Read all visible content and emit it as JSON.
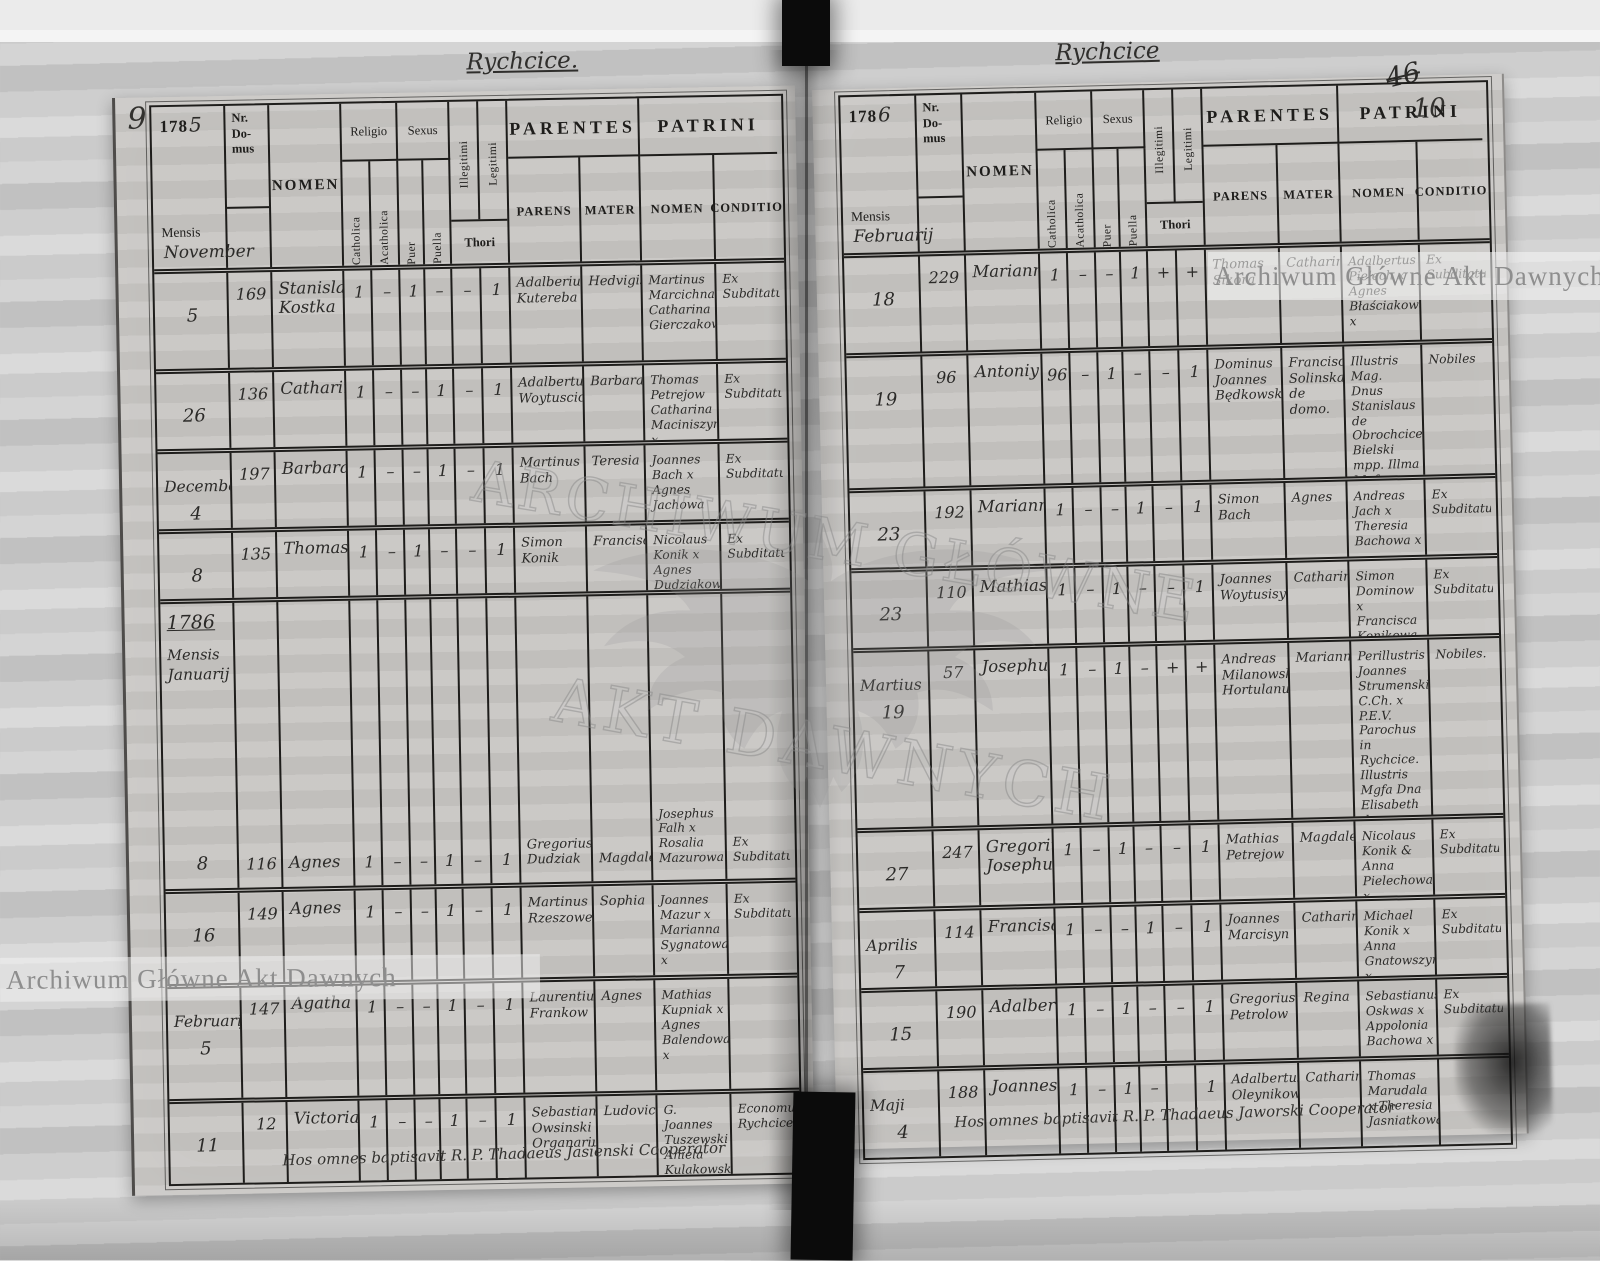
{
  "watermark": {
    "band_text": "Archiwum Główne Akt Dawnych",
    "seal_line1": "ARCHIWUM GŁÓWNE",
    "seal_line2": "AKT DAWNYCH"
  },
  "labels": {
    "mensis": "Mensis",
    "nr1": "Nr.",
    "nr2": "Do-",
    "nr3": "mus",
    "nomen": "NOMEN",
    "religio": "Religio",
    "sexus": "Sexus",
    "catholica": "Catholica",
    "acatholica": "Acatholica",
    "puer": "Puer",
    "puella": "Puella",
    "illegitimi": "Illegitimi",
    "legitimi": "Legitimi",
    "thori": "Thori",
    "parentes": "PARENTES",
    "parens": "PARENS",
    "mater": "MATER",
    "patrini": "PATRINI",
    "patrini_nomen": "NOMEN",
    "conditio": "CONDITIO"
  },
  "left_page": {
    "page_number": "9",
    "title": "Rychcice.",
    "year_print": "178",
    "year_digit": "5",
    "month_header": "November",
    "footer_note": "Hos omnes baptisavit R. P. Thadaeus Jasienski Cooperator",
    "rows": [
      {
        "date": "5",
        "nr": "169",
        "nomen": "Stanislaus Kostka",
        "cath": "1",
        "acath": "–",
        "puer": "1",
        "puella": "–",
        "illeg": "–",
        "leg": "1",
        "parens": "Adalberius Kutereba",
        "mater": "Hedvigis",
        "patrini": "Martinus Marcichna Catharina Gierczakowa",
        "conditio": "Ex Subditatu"
      },
      {
        "date": "26",
        "nr": "136",
        "nomen": "Catharina",
        "cath": "1",
        "acath": "–",
        "puer": "–",
        "puella": "1",
        "illeg": "–",
        "leg": "1",
        "parens": "Adalbertus Woytusciorzy",
        "mater": "Barbara",
        "patrini": "Thomas Petrejow Catharina Maciniszyna x",
        "conditio": "Ex Subditatu"
      },
      {
        "month": "December",
        "date": "4",
        "nr": "197",
        "nomen": "Barbara",
        "cath": "1",
        "acath": "–",
        "puer": "–",
        "puella": "1",
        "illeg": "–",
        "leg": "1",
        "parens": "Martinus Bach",
        "mater": "Teresia",
        "patrini": "Joannes Bach x Agnes Jachowa",
        "conditio": "Ex Subditatu"
      },
      {
        "date": "8",
        "nr": "135",
        "nomen": "Thomas",
        "cath": "1",
        "acath": "–",
        "puer": "1",
        "puella": "–",
        "illeg": "–",
        "leg": "1",
        "parens": "Simon Konik",
        "mater": "Francisca",
        "patrini": "Nicolaus Konik x Agnes Dudziakowa",
        "conditio": "Ex Subditatu"
      },
      {
        "year_note": "1786",
        "mensis_label": "Mensis",
        "month": "Januarij",
        "date": "8",
        "nr": "116",
        "nomen": "Agnes",
        "cath": "1",
        "acath": "–",
        "puer": "–",
        "puella": "1",
        "illeg": "–",
        "leg": "1",
        "parens": "Gregorius Dudziak",
        "mater": "Magdalena",
        "patrini": "Josephus Falh x Rosalia Mazurowa",
        "conditio": "Ex Subditatu"
      },
      {
        "date": "16",
        "nr": "149",
        "nomen": "Agnes",
        "cath": "1",
        "acath": "–",
        "puer": "–",
        "puella": "1",
        "illeg": "–",
        "leg": "1",
        "parens": "Martinus Rzeszowek",
        "mater": "Sophia",
        "patrini": "Joannes Mazur x Marianna Sygnatowa x",
        "conditio": "Ex Subditatu"
      },
      {
        "month": "Februarij",
        "date": "5",
        "nr": "147",
        "nomen": "Agatha",
        "cath": "1",
        "acath": "–",
        "puer": "–",
        "puella": "1",
        "illeg": "–",
        "leg": "1",
        "parens": "Laurentius Frankow",
        "mater": "Agnes",
        "patrini": "Mathias Kupniak x Agnes Balendowa x",
        "conditio": ""
      },
      {
        "date": "11",
        "nr": "12",
        "nomen": "Victoria",
        "cath": "1",
        "acath": "–",
        "puer": "–",
        "puella": "1",
        "illeg": "–",
        "leg": "1",
        "parens": "Sebastian Owsinski Organarius",
        "mater": "Ludovica",
        "patrini": "G. Joannes Tuszewski Aniela Kulakowska",
        "conditio": "Economus Rychcicensis"
      }
    ]
  },
  "right_page": {
    "page_number_old": "46",
    "page_number": "10",
    "title": "Rychcice",
    "year_print": "178",
    "year_digit": "6",
    "month_header": "Februarij",
    "footer_note": "Hos omnes baptisavit R. P. Thadaeus Jaworski Cooperator",
    "rows": [
      {
        "date": "18",
        "nr": "229",
        "nomen": "Marianna",
        "cath": "1",
        "acath": "–",
        "puer": "–",
        "puella": "1",
        "illeg": "+",
        "leg": "+",
        "parens": "Thomas Sikora",
        "mater": "Catharina",
        "patrini": "Adalbertus Pielech x Agnes Błaściakowa x",
        "conditio": "Ex Subditatu"
      },
      {
        "date": "19",
        "nr": "96",
        "nomen": "Antoniy",
        "cath": "96",
        "acath": "–",
        "puer": "1",
        "puella": "–",
        "illeg": "–",
        "leg": "1",
        "parens": "Dominus Joannes Będkowski",
        "mater": "Francisca Solinska de domo.",
        "patrini": "Illustris Mag. Dnus Stanislaus de Obrochcice Bielski mpp. Illma Mgfa Theophila Doliewaltowska mpp.",
        "conditio": "Nobiles"
      },
      {
        "date": "23",
        "nr": "192",
        "nomen": "Marianna",
        "cath": "1",
        "acath": "–",
        "puer": "–",
        "puella": "1",
        "illeg": "–",
        "leg": "1",
        "parens": "Simon Bach",
        "mater": "Agnes",
        "patrini": "Andreas Jach x Theresia Bachowa x",
        "conditio": "Ex Subditatu"
      },
      {
        "date": "23",
        "nr": "110",
        "nomen": "Mathias",
        "cath": "1",
        "acath": "–",
        "puer": "1",
        "puella": "–",
        "illeg": "–",
        "leg": "1",
        "parens": "Joannes Woytusisyn",
        "mater": "Catharina",
        "patrini": "Simon Dominow x Francisca Konikowa x",
        "conditio": "Ex Subditatu"
      },
      {
        "month": "Martius",
        "date": "19",
        "nr": "57",
        "nomen": "Josephus",
        "cath": "1",
        "acath": "–",
        "puer": "1",
        "puella": "–",
        "illeg": "+",
        "leg": "+",
        "parens": "Andreas Milanowski Hortulanus",
        "mater": "Marianna",
        "patrini": "Perillustris Joannes Strumenski C.Ch. x P.E.V. Parochus in Rychcice. Illustris Mgfa Dna Elisabeth de Bielskie Bielska",
        "conditio": "Nobiles."
      },
      {
        "date": "27",
        "nr": "247",
        "nomen": "Gregorius Josephus",
        "cath": "1",
        "acath": "–",
        "puer": "1",
        "puella": "–",
        "illeg": "–",
        "leg": "1",
        "parens": "Mathias Petrejow",
        "mater": "Magdalena",
        "patrini": "Nicolaus Konik & Anna Pielechowa x",
        "conditio": "Ex Subditatu"
      },
      {
        "month": "Aprilis",
        "date": "7",
        "nr": "114",
        "nomen": "Francisca",
        "cath": "1",
        "acath": "–",
        "puer": "–",
        "puella": "1",
        "illeg": "–",
        "leg": "1",
        "parens": "Joannes Marcisyn",
        "mater": "Catharina",
        "patrini": "Michael Konik x Anna Gnatowszyn x",
        "conditio": "Ex Subditatu"
      },
      {
        "date": "15",
        "nr": "190",
        "nomen": "Adalbertus",
        "cath": "1",
        "acath": "–",
        "puer": "1",
        "puella": "–",
        "illeg": "–",
        "leg": "1",
        "parens": "Gregorius Petrolow",
        "mater": "Regina",
        "patrini": "Sebastianus Oskwas x Appolonia Bachowa x",
        "conditio": "Ex Subditatu"
      },
      {
        "month": "Maji",
        "date": "4",
        "nr": "188",
        "nomen": "Joannes",
        "cath": "1",
        "acath": "–",
        "puer": "1",
        "puella": "–",
        "illeg": "",
        "leg": "1",
        "parens": "Adalbertus Oleynikow",
        "mater": "Catharina",
        "patrini": "Thomas Marudala x Theresia Jasniatkowa",
        "conditio": ""
      }
    ]
  }
}
